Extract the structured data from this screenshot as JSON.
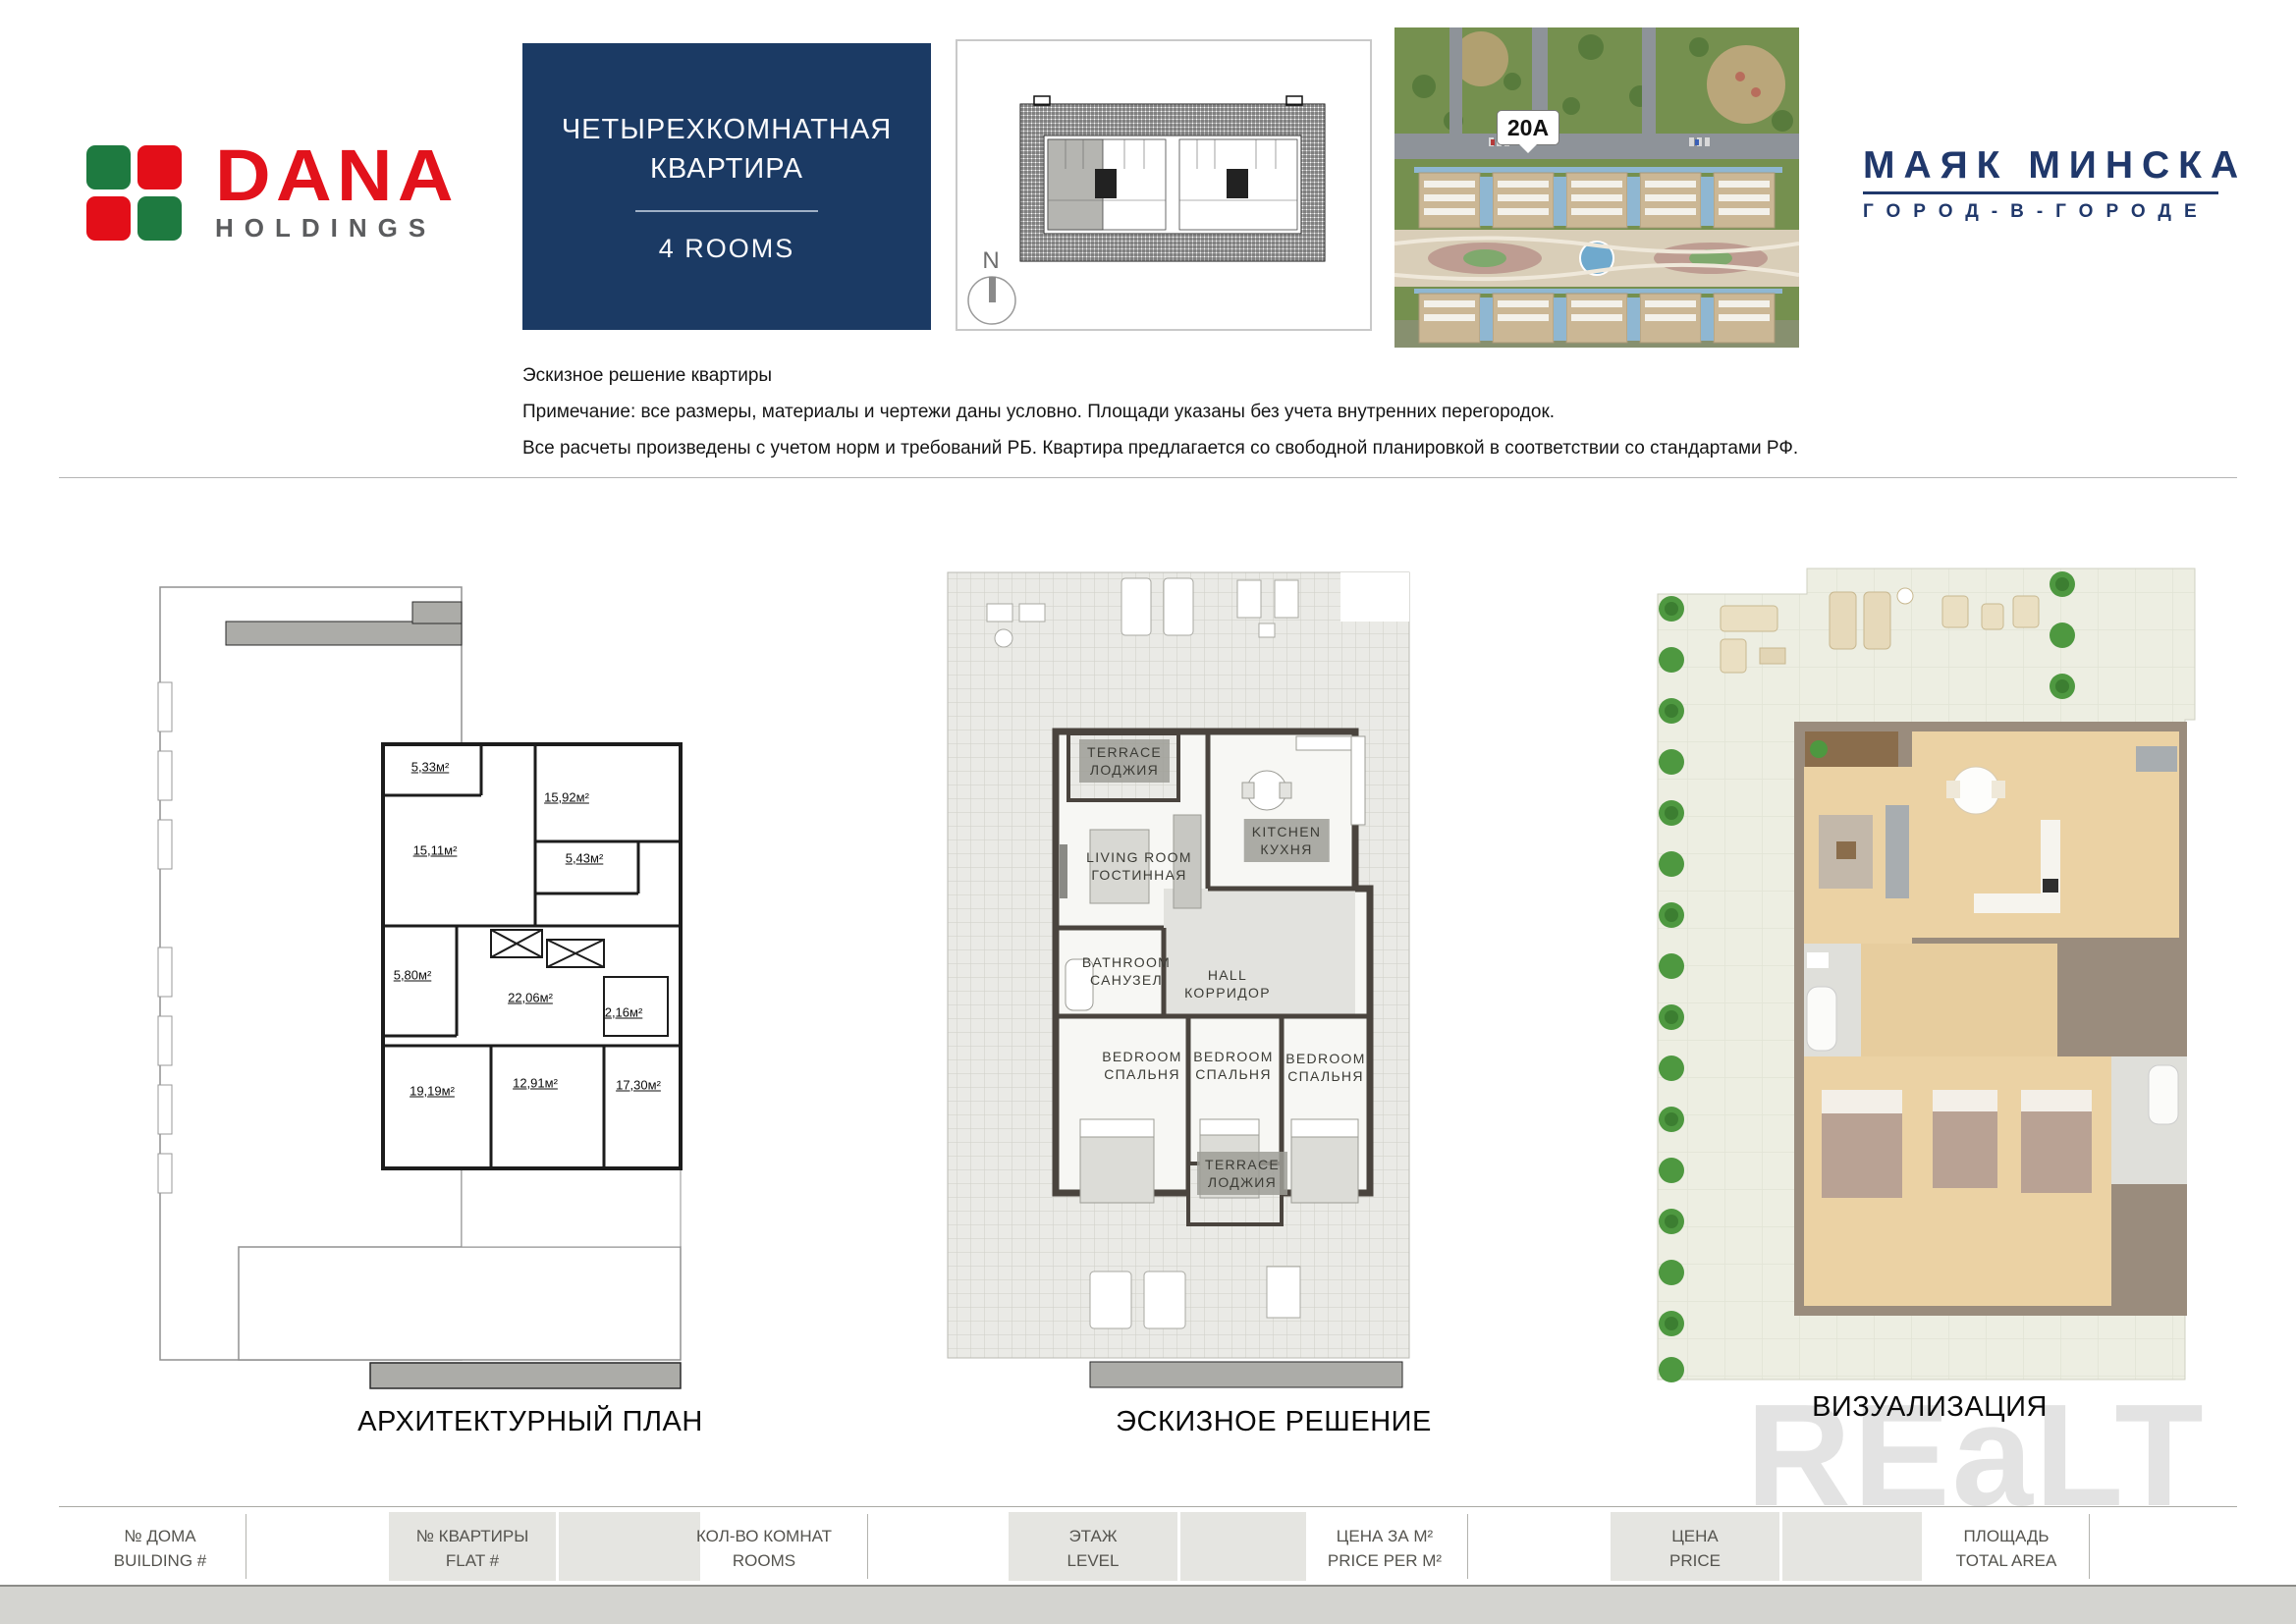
{
  "header": {
    "dana": {
      "word": "DANA",
      "sub": "HOLDINGS"
    },
    "title": {
      "line1": "ЧЕТЫРЕХКОМНАТНАЯ",
      "line2": "КВАРТИРА",
      "rooms": "4 ROOMS"
    },
    "keyplan": {
      "compass": "N"
    },
    "aerial": {
      "label": "20A"
    },
    "mayak": {
      "name": "МАЯК МИНСКА",
      "tagline": "ГОРОД-В-ГОРОДЕ"
    }
  },
  "notes": {
    "line1": "Эскизное решение квартиры",
    "line2": "Примечание: все размеры, материалы и чертежи даны условно. Площади указаны без учета внутренних перегородок.",
    "line3": "Все расчеты произведены с учетом норм и требований РБ. Квартира предлагается со свободной планировкой в соответствии со стандартами РФ."
  },
  "plans": {
    "architectural": {
      "caption": "АРХИТЕКТУРНЫЙ ПЛАН",
      "areas": [
        "5,33м²",
        "15,11м²",
        "15,92м²",
        "5,43м²",
        "5,80м²",
        "22,06м²",
        "2,16м²",
        "19,19м²",
        "12,91м²",
        "17,30м²"
      ]
    },
    "sketch": {
      "caption": "ЭСКИЗНОЕ РЕШЕНИЕ",
      "rooms": [
        {
          "en": "TERRACE",
          "ru": "ЛОДЖИЯ"
        },
        {
          "en": "LIVING ROOM",
          "ru": "ГОСТИННАЯ"
        },
        {
          "en": "KITCHEN",
          "ru": "КУХНЯ"
        },
        {
          "en": "BATHROOM",
          "ru": "САНУЗЕЛ"
        },
        {
          "en": "HALL",
          "ru": "КОРРИДОР"
        },
        {
          "en": "BEDROOM",
          "ru": "СПАЛЬНЯ"
        },
        {
          "en": "BEDROOM",
          "ru": "СПАЛЬНЯ"
        },
        {
          "en": "BEDROOM",
          "ru": "СПАЛЬНЯ"
        },
        {
          "en": "TERRACE",
          "ru": "ЛОДЖИЯ"
        }
      ]
    },
    "visualization": {
      "caption": "ВИЗУАЛИЗАЦИЯ"
    }
  },
  "watermark": "REaLT",
  "footer": {
    "cells": [
      {
        "ru": "№ ДОМА",
        "en": "BUILDING #"
      },
      {
        "ru": "№ КВАРТИРЫ",
        "en": "FLAT #"
      },
      {
        "ru": "КОЛ-ВО КОМНАТ",
        "en": "ROOMS"
      },
      {
        "ru": "ЭТАЖ",
        "en": "LEVEL"
      },
      {
        "ru": "ЦЕНА ЗА М²",
        "en": "PRICE PER M²"
      },
      {
        "ru": "ЦЕНА",
        "en": "PRICE"
      },
      {
        "ru": "ПЛОЩАДЬ",
        "en": "TOTAL AREA"
      }
    ]
  }
}
